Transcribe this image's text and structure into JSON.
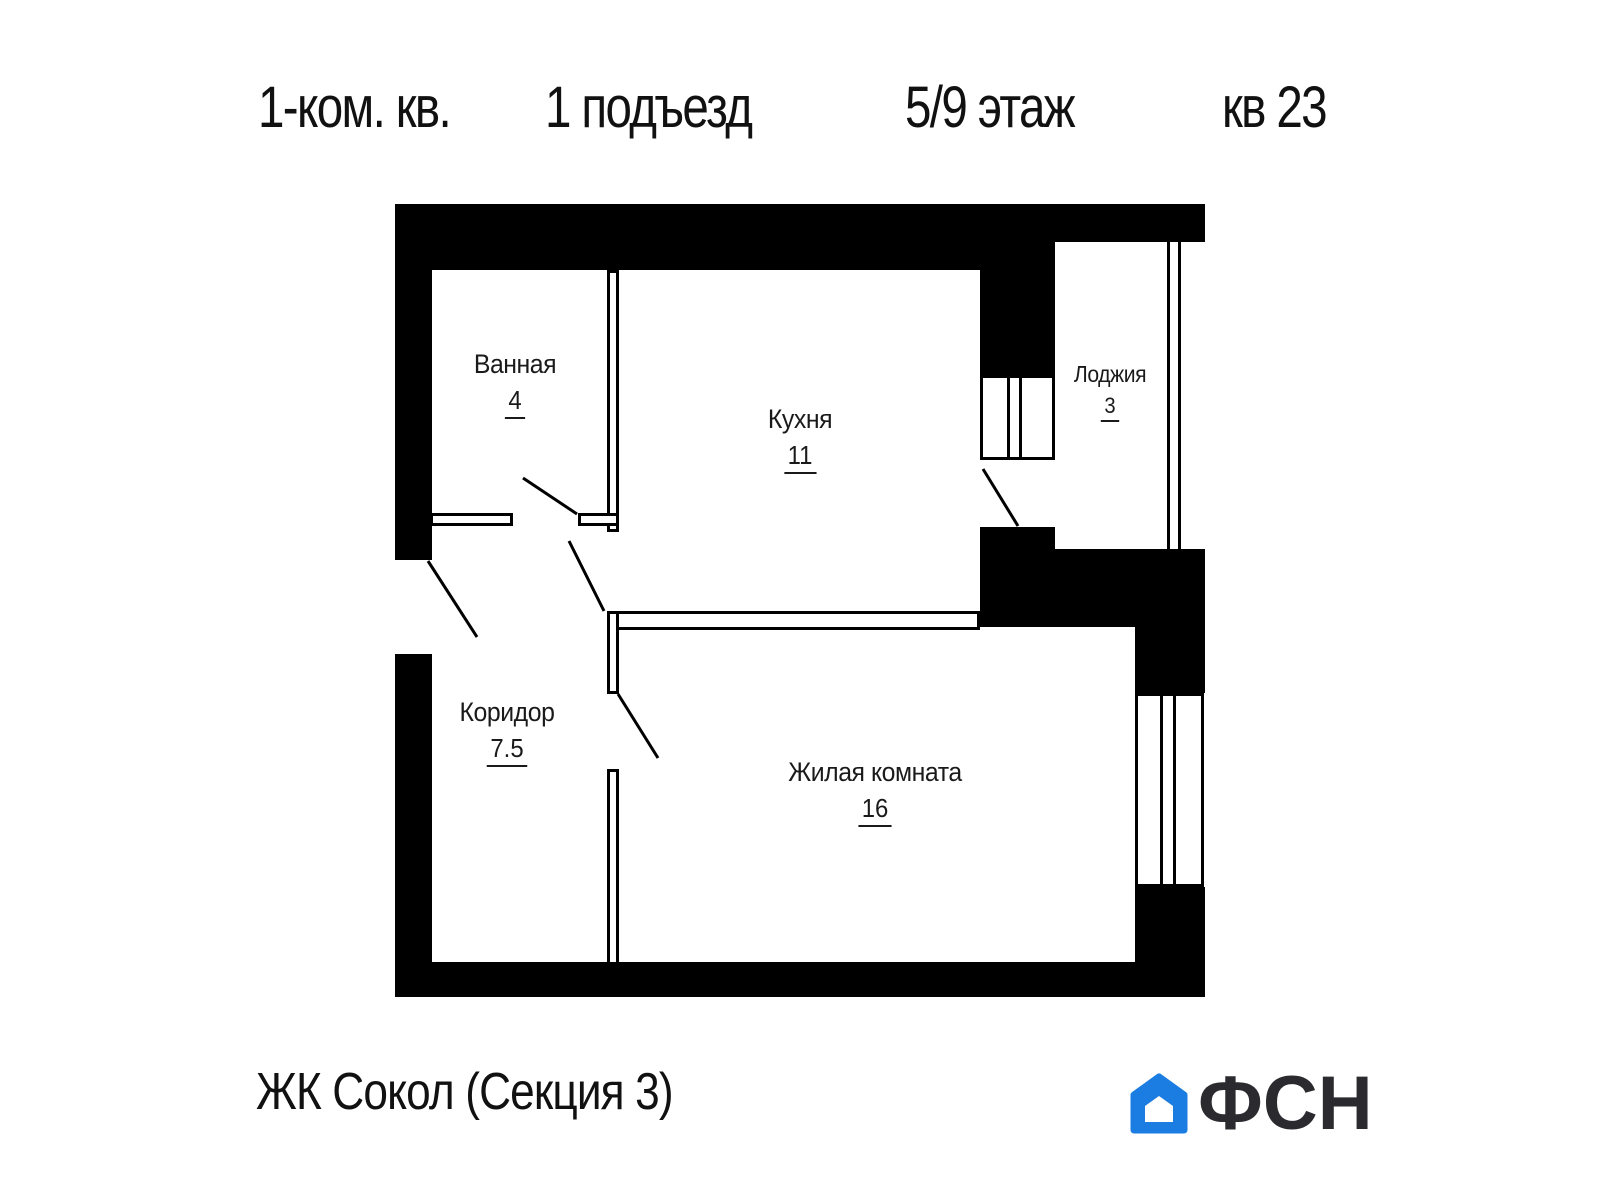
{
  "header": {
    "apartment_type": "1-ком. кв.",
    "entrance": "1 подъезд",
    "floor": "5/9 этаж",
    "unit": "кв 23"
  },
  "rooms": [
    {
      "name": "Ванная",
      "area": "4"
    },
    {
      "name": "Кухня",
      "area": "11"
    },
    {
      "name": "Лоджия",
      "area": "3"
    },
    {
      "name": "Коридор",
      "area": "7.5"
    },
    {
      "name": "Жилая комната",
      "area": "16"
    }
  ],
  "footer": {
    "project": "ЖК Сокол (Секция 3)",
    "logo_text": "ФСН"
  },
  "colors": {
    "walls": "#000000",
    "logo_blue": "#1b7ce2",
    "logo_dark": "#2b2b2f",
    "background": "#ffffff",
    "text": "#1a1a1a"
  }
}
